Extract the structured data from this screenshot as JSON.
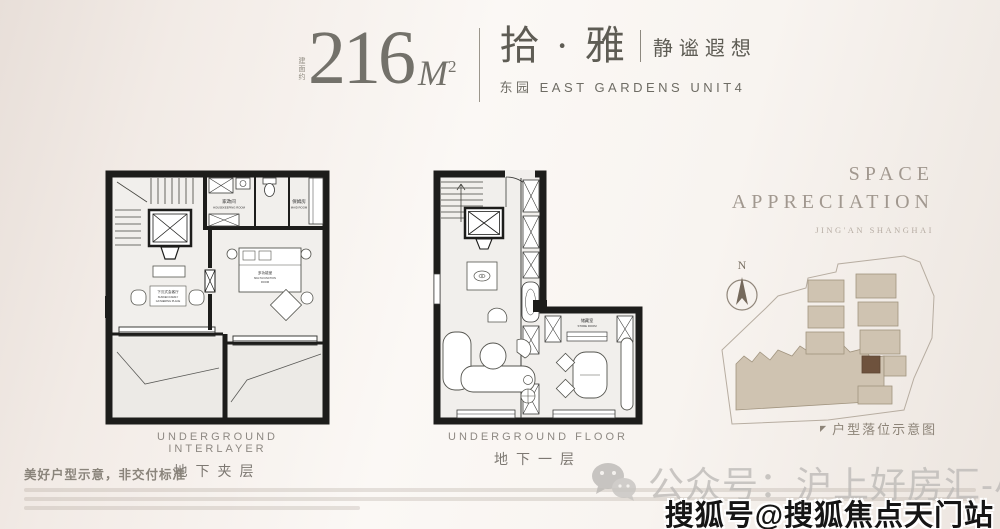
{
  "header": {
    "area_note": "建面约",
    "area_value": "216",
    "area_unit": "M",
    "area_exp": "2",
    "name": "拾 · 雅",
    "tagline": "静谧遐想",
    "subline": "东园 EAST GARDENS UNIT4"
  },
  "plans": {
    "left": {
      "caption_en": "UNDERGROUND INTERLAYER",
      "caption_cn": "地下夹层",
      "rooms": {
        "housekeeping_cn": "家政间",
        "housekeeping_en": "HOUSEKEEPING ROOM",
        "maid_cn": "保姆房",
        "maid_en": "MAID ROOM",
        "gathering_cn": "下沉式会客厅",
        "gathering_en1": "SUNKEN FAMILY",
        "gathering_en2": "GATHERING PLACE",
        "multi_cn": "多功能室",
        "multi_en1": "MULTI-FUNCTION",
        "multi_en2": "ROOM"
      }
    },
    "right": {
      "caption_en": "UNDERGROUND FLOOR",
      "caption_cn": "地下一层",
      "rooms": {
        "store_cn": "储藏室",
        "store_en": "STORE ROOM"
      }
    }
  },
  "side": {
    "title1": "SPACE",
    "title2": "APPRECIATION",
    "subtitle": "JING'AN SHANGHAI",
    "compass": "N",
    "siteplan_marker": "◤",
    "siteplan_label": "户型落位示意图"
  },
  "footer": {
    "notice": "美好户型示意，非交付标准",
    "wechat": "公众号：沪上好房汇-小跃",
    "sohu": "搜狐号@搜狐焦点天门站"
  },
  "colors": {
    "wall": "#1d1d1b",
    "building_tan": "#cfc3b1",
    "building_highlight": "#6e523d"
  }
}
